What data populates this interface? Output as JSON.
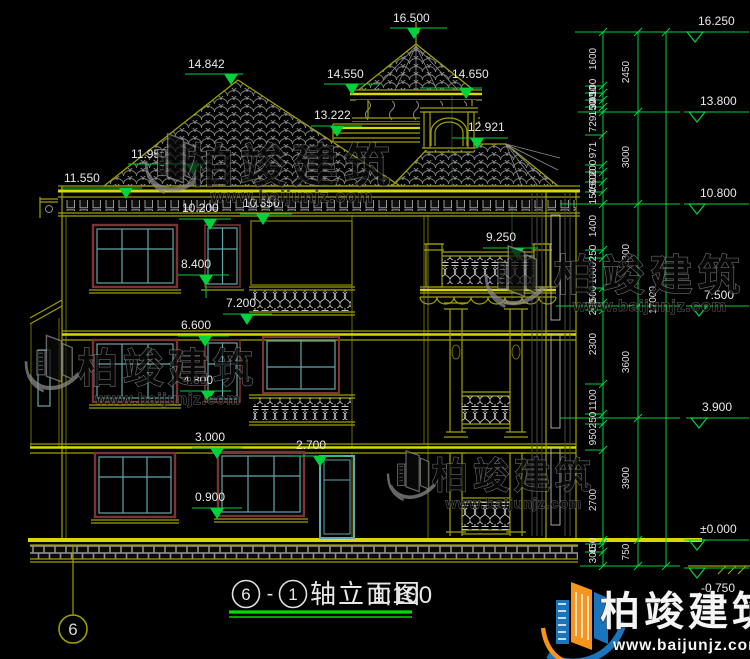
{
  "drawing_title": {
    "axis_from": "6",
    "separator": "-",
    "axis_to": "1",
    "name": "轴立面图",
    "scale": "1:100"
  },
  "axis_bubble": {
    "label": "6"
  },
  "elev_left": [
    "16.500",
    "14.842",
    "14.550",
    "14.650",
    "13.222",
    "12.921",
    "11.950",
    "11.550",
    "10.200",
    "10.350",
    "9.250",
    "8.400",
    "7.200",
    "6.600",
    "4.800",
    "3.000",
    "2.700",
    "0.900"
  ],
  "elev_right": [
    "16.250",
    "13.800",
    "10.800",
    "7.500",
    "3.900",
    "±0.000",
    "-0.750"
  ],
  "dims": {
    "col1": [
      "1600",
      "100",
      "450",
      "300",
      "150",
      "729",
      "971",
      "200",
      "600",
      "450",
      "150",
      "1400",
      "250",
      "1000",
      "500",
      "200",
      "2300",
      "1100",
      "250",
      "950",
      "2700",
      "450",
      "300"
    ],
    "col2": [
      "2450",
      "3000",
      "3300",
      "3600",
      "3900",
      "750"
    ],
    "total": "17000"
  },
  "watermark": {
    "name": "柏竣建筑",
    "url": "www.baijunjz.com",
    "brand_orange": "#f7941d",
    "brand_blue": "#1b75bc",
    "gray": "#909090"
  }
}
